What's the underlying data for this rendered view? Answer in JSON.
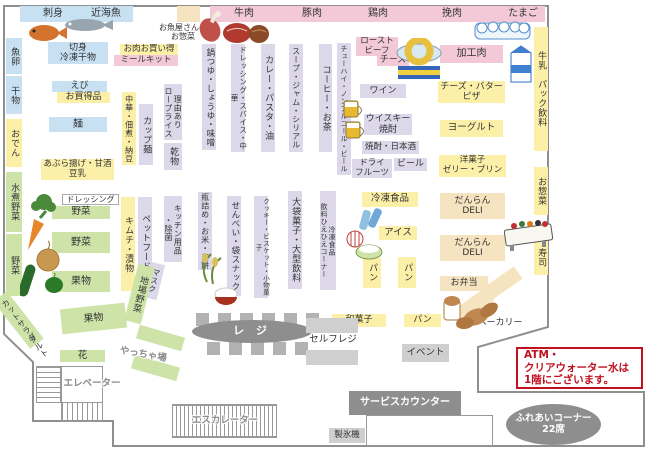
{
  "top_bars": {
    "sashimi": "刺身",
    "kinkaigyo": "近海魚",
    "gyuniku": "牛肉",
    "butaniku": "豚肉",
    "toriniku": "鶏肉",
    "hikiniku": "挽肉",
    "tamago": "たまご"
  },
  "left_strip": {
    "gyoran": "魚卵",
    "himono": "干物",
    "oden": "おでん",
    "mizuni_yasai": "水煮野菜",
    "yasai": "野菜"
  },
  "seafood": {
    "osakanaya": "お魚屋さんの\nお惣菜",
    "kirimi": "切身\n冷凍干物",
    "oniku_okaidoku": "お肉お買い得",
    "meal_kit": "ミールキット",
    "ebi": "えび",
    "okaidokuhin": "お買得品",
    "men": "麺",
    "aburaage": "あぶら揚げ・甘酒\n豆乳"
  },
  "aisles_top": {
    "nabetsuyu": "鍋つゆ・しょうゆ・味噌",
    "chuka_tsukudani": "中華・佃煮・納豆",
    "cup_men": "カップ麺",
    "riyuari": "理由あり\nロープライス",
    "kanbutsu": "乾物",
    "dressing_spice": "ドレッシング・スパイス・中華",
    "curry_pasta": "カレー・パスタ・油",
    "soup_jam": "スープ・ジャム・シリアル",
    "coffee_tea": "コーヒー・お茶",
    "chuhai": "チューハイ・ノンアルコール・ビール"
  },
  "aisles_mid": {
    "kimchi": "キムチ・漬物",
    "pet_food": "ペットフード",
    "kitchen": "キッチン用品\n・除菌",
    "mask": "マスク",
    "binzume": "瓶詰め・お米・お餅",
    "senbei": "せんべい・袋スナック",
    "cookie": "クッキー・ビスケット・小物菓子",
    "obukuro": "大袋菓子・大型飲料",
    "reito_hiehie": "冷凍食品\n飲料ひえひえコーナー"
  },
  "liquor": {
    "roast_beef": "ロースト\nビーフ",
    "cheese": "チーズ",
    "wine": "ワイン",
    "whisky": "ウイスキー\n焼酎",
    "shochu_nihonshu": "焼酎・日本酒",
    "dry_fruits": "ドライ\nフルーツ",
    "beer": "ビール"
  },
  "frozen": {
    "reito_shokuhin": "冷凍食品",
    "ice": "アイス",
    "pan1": "パン",
    "pan2": "パン"
  },
  "dairy": {
    "kakoniku": "加工肉",
    "cheese_butter": "チーズ・バター\nピザ",
    "yogurt": "ヨーグルト",
    "yogashi": "洋菓子\nゼリー・プリン",
    "gyunyu_pack": "牛乳　パック飲料"
  },
  "deli": {
    "danran1": "だんらん\nDELI",
    "danran2": "だんらん\nDELI",
    "obento": "お弁当",
    "osozai": "お惣菜",
    "sushi": "寿司",
    "bakery": "ベーカリー",
    "pan_bottom": "パン",
    "wagashi": "和菓子"
  },
  "produce": {
    "dressing": "ドレッシング",
    "yasai1": "野菜",
    "yasai2": "野菜",
    "kudamono1": "果物",
    "kudamono2": "果物",
    "jiba_yasai": "地場野菜",
    "cut_salad": "カットサラダ",
    "tart": "タルト",
    "hana": "花",
    "yacchaba": "やっちゃ場"
  },
  "checkout": {
    "reji": "レ ジ",
    "self_reji": "セルフレジ",
    "event": "イベント"
  },
  "facilities": {
    "service_counter": "サービスカウンター",
    "seihyoki": "製氷機",
    "fureai": "ふれあいコーナー\n22席",
    "elevator": "エレベーター",
    "escalator": "エスカレーター"
  },
  "notice": {
    "text": "ATM・\nクリアウォーター水は\n1階にございます。"
  },
  "colors": {
    "seafood_blue": "#c7e1f3",
    "meat_pink": "#f3c9d8",
    "grocery_yellow": "#fcf0a8",
    "aisle_lavender": "#dcd8ea",
    "produce_green": "#cde3a8",
    "deli_cream": "#f6e3bf",
    "gray_dark": "#8e8e8e",
    "gray_light": "#cfcfcf",
    "notice_red": "#c11120"
  }
}
